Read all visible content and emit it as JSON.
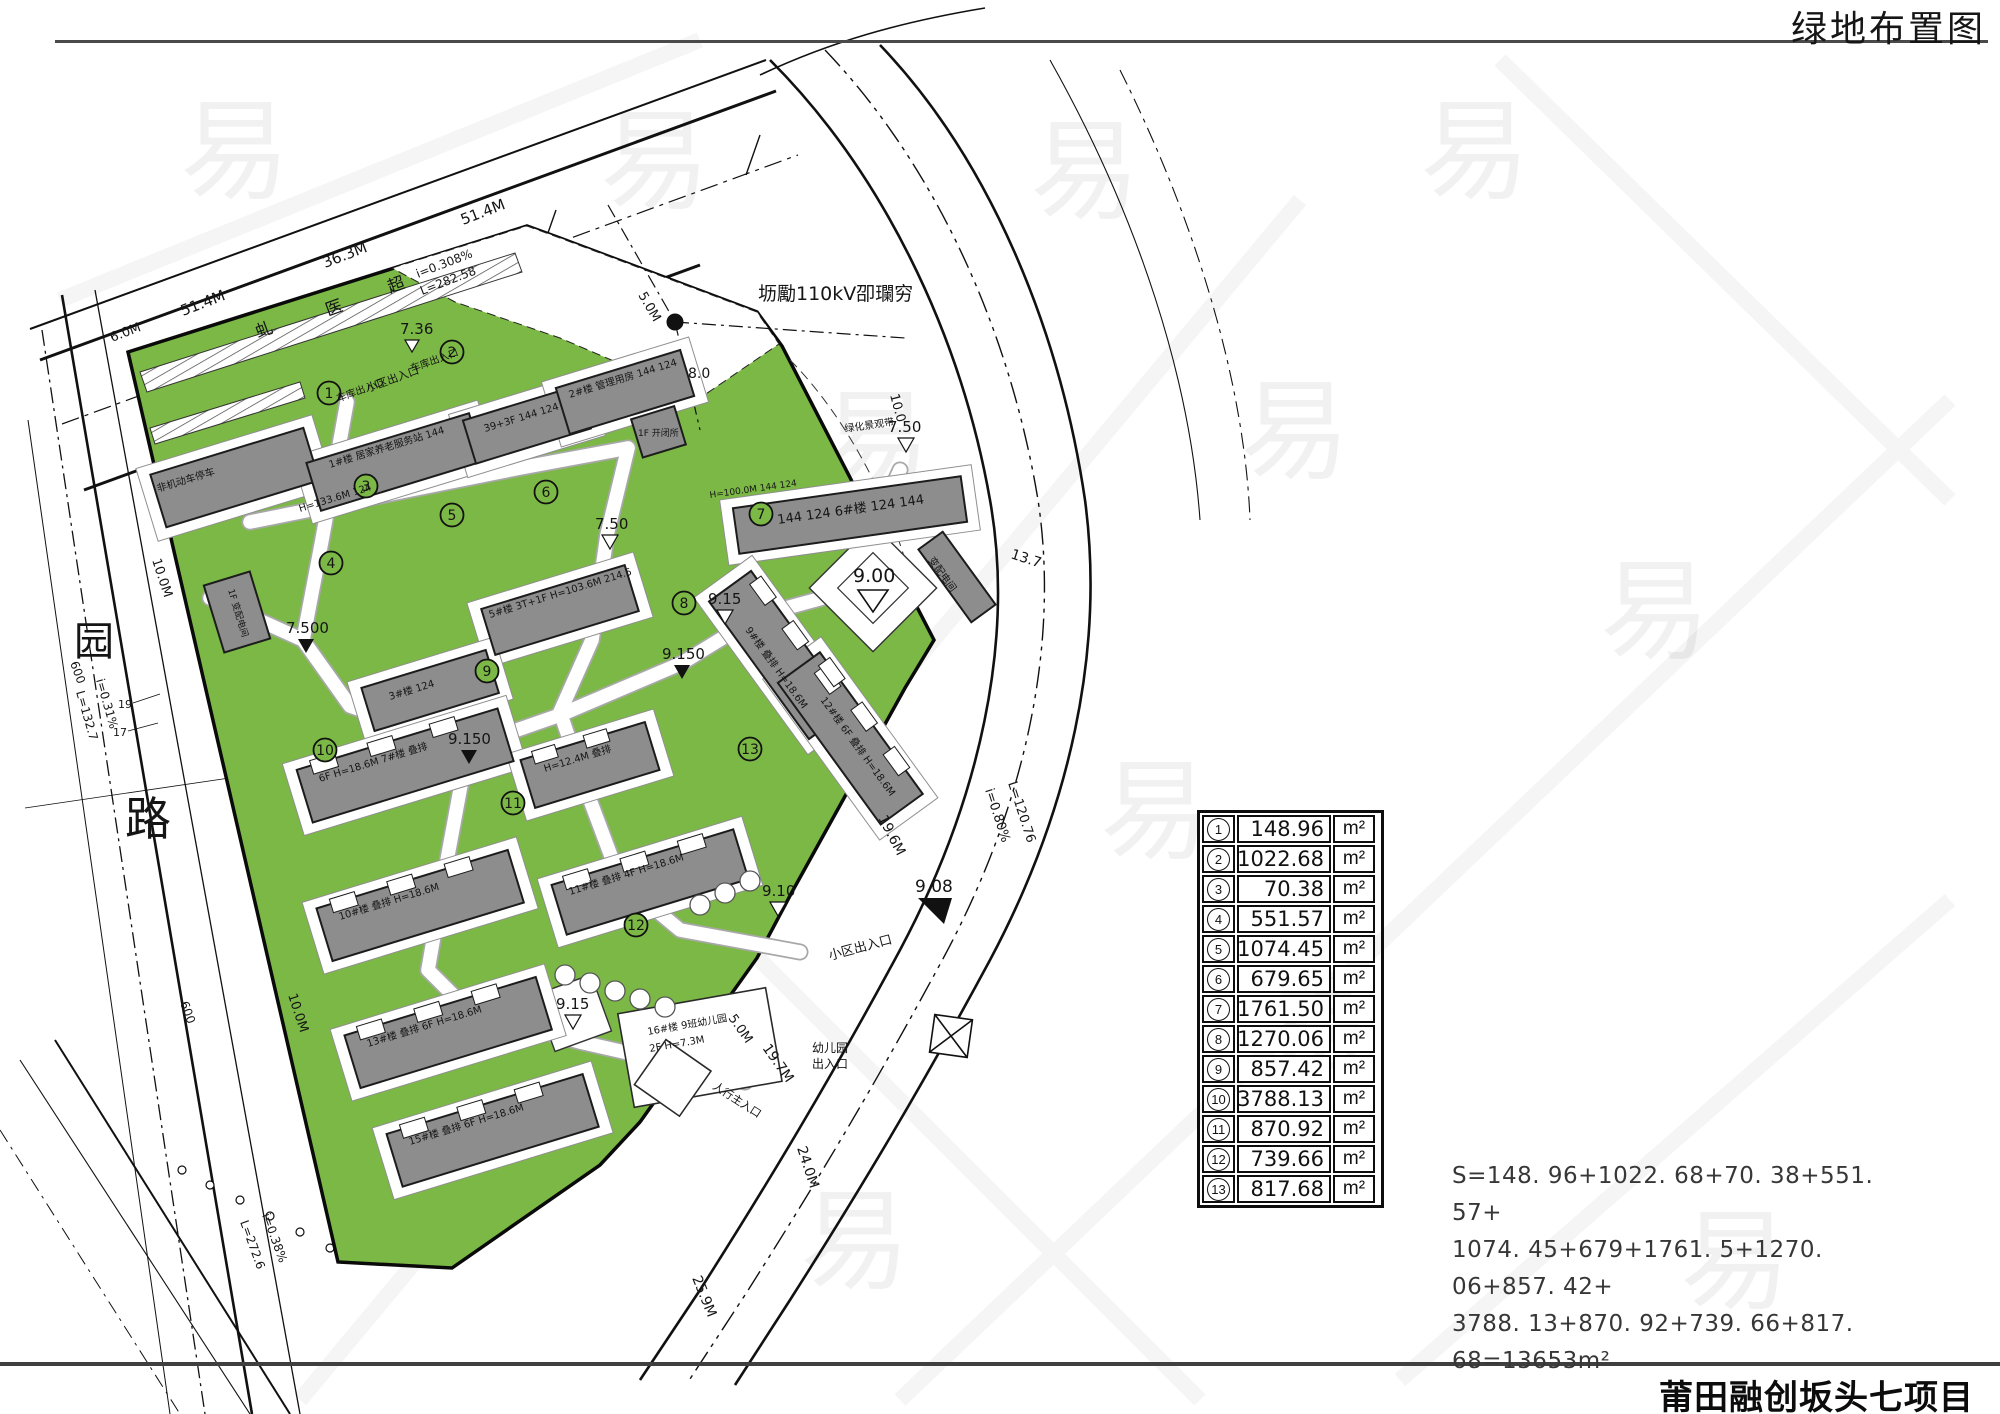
{
  "title": "绿地布置图",
  "footer": "莆田融创坂头七项目",
  "colors": {
    "green": "#7CB845",
    "building_gray": "#8D8D8D",
    "line": "#111111"
  },
  "table": {
    "unit": "m²",
    "rows": [
      {
        "badge": "1",
        "value": "148.96"
      },
      {
        "badge": "2",
        "value": "1022.68"
      },
      {
        "badge": "3",
        "value": "70.38"
      },
      {
        "badge": "4",
        "value": "551.57"
      },
      {
        "badge": "5",
        "value": "1074.45"
      },
      {
        "badge": "6",
        "value": "679.65"
      },
      {
        "badge": "7",
        "value": "1761.50"
      },
      {
        "badge": "8",
        "value": "1270.06"
      },
      {
        "badge": "9",
        "value": "857.42"
      },
      {
        "badge": "10",
        "value": "3788.13"
      },
      {
        "badge": "11",
        "value": "870.92"
      },
      {
        "badge": "12",
        "value": "739.66"
      },
      {
        "badge": "13",
        "value": "817.68"
      }
    ]
  },
  "formula": {
    "line1": "S=148. 96+1022. 68+70. 38+551. 57+",
    "line2": "1074. 45+679+1761. 5+1270. 06+857. 42+",
    "line3": "3788. 13+870. 92+739. 66+817. 68=13653m²"
  },
  "map": {
    "watermark": "易",
    "badges": [
      "1",
      "2",
      "3",
      "4",
      "5",
      "6",
      "7",
      "8",
      "9",
      "10",
      "11",
      "12",
      "13"
    ],
    "labels": {
      "corridor": "坜勵110kV卲瓓穷",
      "greenbelt": "绿化景观带",
      "road_name_yuan": "园",
      "road_name_lu": "路",
      "road_char_1": "虬",
      "road_char_2": "医",
      "road_char_3": "超",
      "dim_51_4_a": "51.4M",
      "dim_36_3": "36.3M",
      "dim_51_4_b": "51.4M",
      "dim_6_0": "6.0M",
      "dim_5_0_a": "5.0M",
      "dim_5_0_b": "5.0M",
      "dim_7_36": "7.36",
      "dim_8_0": "8.0",
      "dim_10_0": "10.0",
      "dim_13_7": "13.7",
      "dim_19_6": "19.6M",
      "dim_19_7": "19.7M",
      "dim_24_0": "24.0M",
      "dim_25_9": "25.9M",
      "dim_10_0m_a": "10.0M",
      "dim_10_0m_b": "10.0M",
      "dim_600_a": "600",
      "dim_600_b": "600",
      "num_19": "19",
      "num_17": "17",
      "slope_top_i": "i=0.308%",
      "slope_top_l": "L=282.58",
      "slope_right_i": "i=0.80%",
      "slope_right_l": "L=120.76",
      "slope_left_i": "i=0.31%",
      "slope_left_l": "L=132.7",
      "slope_bl_i": "i=0.38%",
      "slope_bl_l": "L=272.6",
      "lv_750": "7.50",
      "lv_7500": "7.500",
      "lv_9150": "9.150",
      "lv_915": "9.15",
      "lv_900": "9.00",
      "lv_910": "9.10",
      "lv_908": "9.08",
      "ent_parking": "车库出入口",
      "ent_community": "小区出入口",
      "ent_kindergarten_1": "幼儿园",
      "ent_kindergarten_2": "出入口",
      "ent_pedestrian": "人行主入口",
      "bld_nonmotor": "非机动车停车",
      "bld_1": "1#楼 居家养老服务站 144",
      "bld_h1336": "H=133.6M 124",
      "bld_39f": "39+3F 144 124",
      "bld_2": "2#楼 管理用房 144 124",
      "bld_kaibisuo": "1F 开闭所",
      "bld_bianpei_w": "1F 变配电间",
      "bld_bianpei_e": "变配电间",
      "bld_5": "5#楼 3T+1F H=103.6M 214.5",
      "bld_6": "144 124 6#楼 124 144",
      "bld_6h": "H=100.0M 144 124",
      "bld_3": "3#楼 124",
      "row_7": "6F H=18.6M 7#楼 叠排",
      "row_9": "9#楼 叠排 H=18.6M",
      "row_12": "12#楼 6F 叠排 H=18.6M",
      "row_10": "10#楼 叠排 H=18.6M",
      "row_11": "11#楼 叠排 4F H=18.6M",
      "row_13": "13#楼 叠排 6F H=18.6M",
      "row_15": "15#楼 叠排 6F H=18.6M",
      "row_hm124": "H=12.4M 叠排",
      "kg_1": "16#楼 9班幼儿园",
      "kg_2": "2F H=7.3M"
    }
  }
}
